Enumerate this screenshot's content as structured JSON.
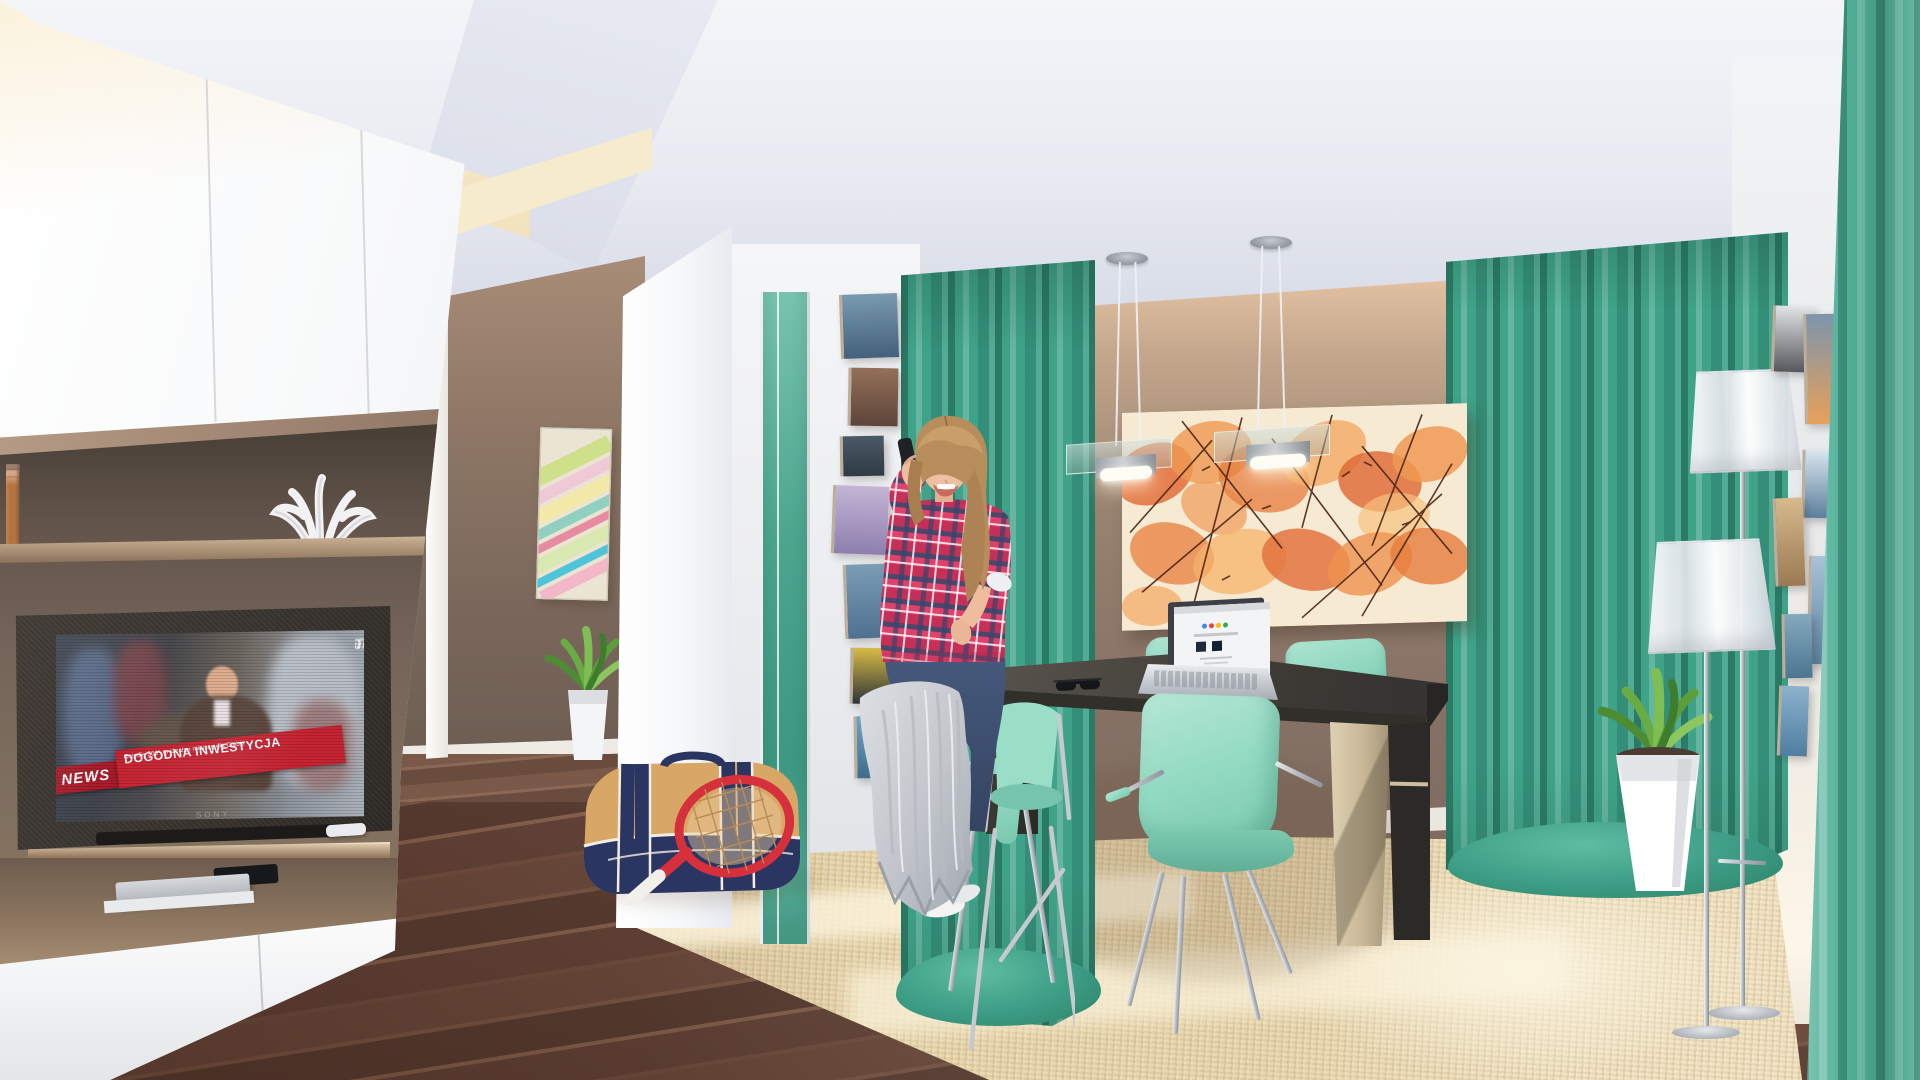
{
  "image": {
    "type": "3d interior visualization",
    "room": "open living and dining room",
    "subjects": "woman talking on phone, TV news broadcast, dining set, teal curtains"
  },
  "tv": {
    "logo_prefix": "uni",
    "logo_suffix": "TV",
    "news_label": "NEWS",
    "headline": "DOGODNA INWESTYCJA",
    "subheadline": "Osiedle 360° to idealne miejsce dla Ciebie",
    "brand": "SONY"
  },
  "palette": {
    "curtain_teal": "#3fa389",
    "curtain_foreground": "#54b29a",
    "chair_mint": "#93dac3",
    "wall_taupe": "#867165",
    "cabinet_bronze": "#9d8370",
    "rug_beige": "#e9d7ae",
    "floor_wood": "#6e4d3f",
    "news_red": "#c72433",
    "painting_orange": "#e06028",
    "table_charcoal": "#3b3834",
    "leg_champagne": "#c8b897",
    "ceiling_grey": "#e9ebf2"
  },
  "bookshelf": {
    "books": [
      {
        "c": "#a98d6d",
        "h": 86,
        "w": 13
      },
      {
        "c": "#c7a787",
        "h": 78,
        "w": 12
      },
      {
        "c": "#8d6f55",
        "h": 88,
        "w": 14
      },
      {
        "c": "#d4b090",
        "h": 74,
        "w": 11
      },
      {
        "c": "#b9889a",
        "h": 90,
        "w": 13
      },
      {
        "c": "#c997a6",
        "h": 80,
        "w": 12
      },
      {
        "c": "#e0c3a6",
        "h": 72,
        "w": 12
      },
      {
        "c": "#c08b7e",
        "h": 88,
        "w": 14
      },
      {
        "c": "#b97f8d",
        "h": 82,
        "w": 12
      },
      {
        "c": "#d9aa92",
        "h": 90,
        "w": 13
      },
      {
        "c": "#c69a7c",
        "h": 76,
        "w": 12
      },
      {
        "c": "#b08a96",
        "h": 88,
        "w": 13
      },
      {
        "c": "#e3c7ae",
        "h": 70,
        "w": 11
      },
      {
        "c": "#d4a0a8",
        "h": 84,
        "w": 13
      },
      {
        "c": "#efd9c2",
        "h": 88,
        "w": 12
      },
      {
        "c": "#8a6a52",
        "h": 80,
        "w": 12
      },
      {
        "c": "#7d5c44",
        "h": 90,
        "w": 14
      },
      {
        "c": "#c98f6a",
        "h": 84,
        "w": 13
      },
      {
        "c": "#b5743f",
        "h": 78,
        "w": 13
      }
    ]
  },
  "photo_walls": {
    "left": [
      {
        "l": 22,
        "t": 6,
        "w": 58,
        "h": 64,
        "c1": "#7a9ab0",
        "c2": "#43607c",
        "tilt": -2
      },
      {
        "l": 30,
        "t": 80,
        "w": 50,
        "h": 58,
        "c1": "#93705a",
        "c2": "#5d4538",
        "tilt": 1
      },
      {
        "l": 22,
        "t": 148,
        "w": 44,
        "h": 40,
        "c1": "#4a5a66",
        "c2": "#2e3a44",
        "tilt": -1
      },
      {
        "l": 14,
        "t": 198,
        "w": 56,
        "h": 68,
        "c1": "#c3b5d4",
        "c2": "#8d7fae",
        "tilt": 2
      },
      {
        "l": 26,
        "t": 276,
        "w": 56,
        "h": 74,
        "c1": "#7b9cb5",
        "c2": "#4f7190",
        "tilt": -2
      },
      {
        "l": 32,
        "t": 360,
        "w": 46,
        "h": 56,
        "c1": "#d8bb45",
        "c2": "#2c3338",
        "tilt": 1
      },
      {
        "l": 36,
        "t": 428,
        "w": 50,
        "h": 62,
        "c1": "#6fa3c2",
        "c2": "#3f6d8c",
        "tilt": -1
      }
    ],
    "right": [
      {
        "l": 14,
        "t": 8,
        "w": 40,
        "h": 66,
        "c1": "#e3e4e6",
        "c2": "#55585c",
        "tilt": 2
      },
      {
        "l": 46,
        "t": 16,
        "w": 32,
        "h": 110,
        "c1": "#7c95ad",
        "c2": "#e8a05a",
        "tilt": -1
      },
      {
        "l": 44,
        "t": 152,
        "w": 30,
        "h": 68,
        "c1": "#d8e6f0",
        "c2": "#5d7f9c",
        "tilt": 1
      },
      {
        "l": 16,
        "t": 200,
        "w": 30,
        "h": 88,
        "c1": "#d6b98c",
        "c2": "#9a7a52",
        "tilt": -2
      },
      {
        "l": 50,
        "t": 258,
        "w": 26,
        "h": 108,
        "c1": "#a9c3d8",
        "c2": "#5d82a3",
        "tilt": 1
      },
      {
        "l": 24,
        "t": 316,
        "w": 30,
        "h": 64,
        "c1": "#85aabf",
        "c2": "#4c7590",
        "tilt": -1
      },
      {
        "l": 20,
        "t": 388,
        "w": 30,
        "h": 70,
        "c1": "#8cb2cc",
        "c2": "#4f7ea0",
        "tilt": 2
      }
    ]
  }
}
